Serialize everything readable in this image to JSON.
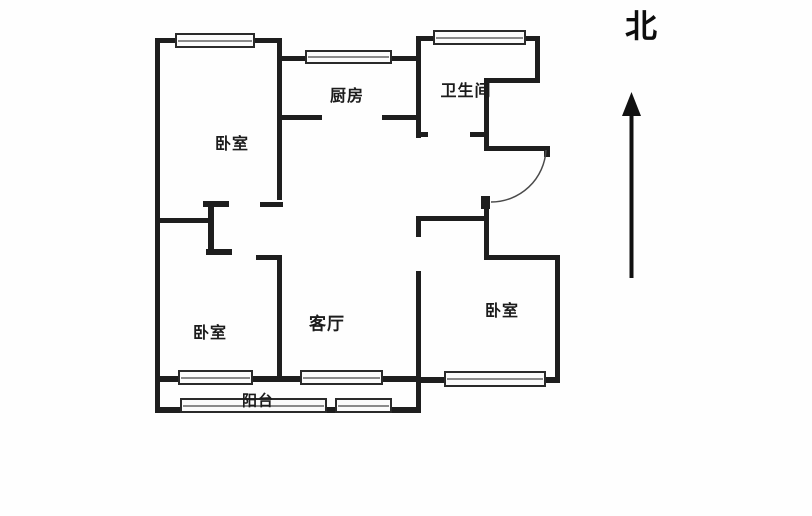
{
  "floorplan": {
    "rooms": {
      "bedroom_top_left": {
        "label": "卧室"
      },
      "kitchen": {
        "label": "厨房"
      },
      "bathroom": {
        "label": "卫生间"
      },
      "living_room": {
        "label": "客厅"
      },
      "bedroom_bottom_left": {
        "label": "卧室"
      },
      "bedroom_right": {
        "label": "卧室"
      },
      "balcony": {
        "label": "阳台"
      }
    },
    "compass": {
      "north_label": "北"
    },
    "colors": {
      "wall": "#1e1e1e",
      "background": "#ffffff",
      "window_border": "#2a2a2a",
      "window_mid_line": "#8a8a8a",
      "door_arc": "#4a4a4a"
    }
  }
}
